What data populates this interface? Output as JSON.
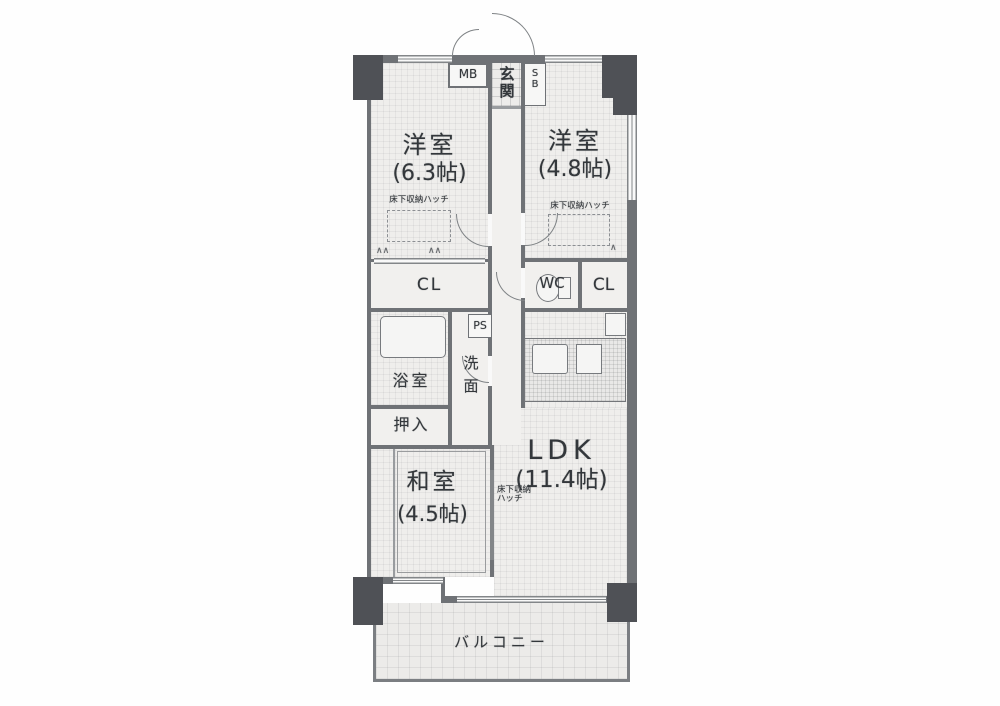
{
  "labels": {
    "mb": "MB",
    "genkan": [
      "玄",
      "関"
    ],
    "sb": [
      "S",
      "B"
    ],
    "room1": {
      "name": "洋室",
      "size": "(6.3帖)",
      "note": "床下収納ハッチ"
    },
    "room2": {
      "name": "洋室",
      "size": "(4.8帖)",
      "note": "床下収納ハッチ"
    },
    "cl_left": "CL",
    "cl_right": "CL",
    "wc": "WC",
    "ps": "PS",
    "bath": "浴室",
    "wash": [
      "洗",
      "面"
    ],
    "oshiire": "押入",
    "washitsu": {
      "name": "和室",
      "size": "(4.5帖)"
    },
    "ldk": {
      "name": "LDK",
      "size": "(11.4帖)",
      "note_line1": "床下収納",
      "note_line2": "ハッチ"
    },
    "balcony": "バルコニー",
    "hanger_left_a": "∧∧",
    "hanger_left_b": "∧∧",
    "hanger_right": "∧"
  },
  "colors": {
    "wall": "#6e7176",
    "pillar": "#4c4f54",
    "ink": "#2f3337",
    "floor": "#f5f4f2",
    "paper": "#ffffff"
  }
}
